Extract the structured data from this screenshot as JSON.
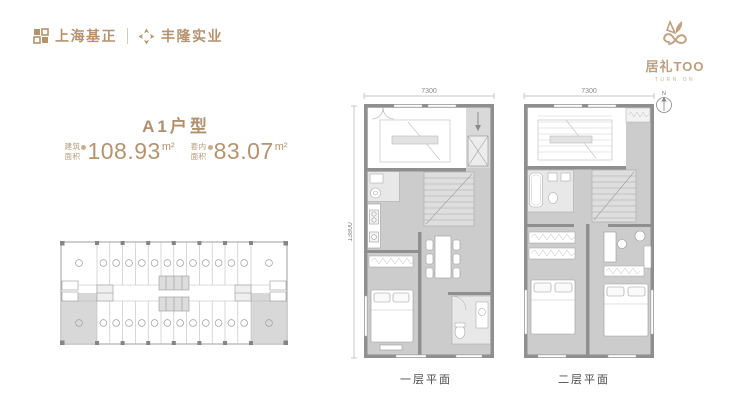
{
  "colors": {
    "accent": "#b5936f",
    "brand": "#bf9e7d",
    "plan_floor": "#cccccc",
    "plan_wall": "#8f8f8f",
    "label_text": "#4c4c4c"
  },
  "header": {
    "developer_logos": [
      {
        "name": "上海基正"
      },
      {
        "name": "丰隆实业"
      }
    ],
    "brand": {
      "name": "居礼TOO",
      "tagline": "TURN ON"
    }
  },
  "unit": {
    "title": "A1户型",
    "areas": [
      {
        "label_line1": "建筑",
        "label_line2": "面积",
        "value": "108.93",
        "unit": "m²"
      },
      {
        "label_line1": "套内",
        "label_line2": "面积",
        "value": "83.07",
        "unit": "m²"
      }
    ]
  },
  "plans": {
    "floor1": {
      "label": "一层平面",
      "width_dim": "7300",
      "height_dim": "13800"
    },
    "floor2": {
      "label": "二层平面",
      "width_dim": "7300"
    },
    "north_label": "N"
  }
}
